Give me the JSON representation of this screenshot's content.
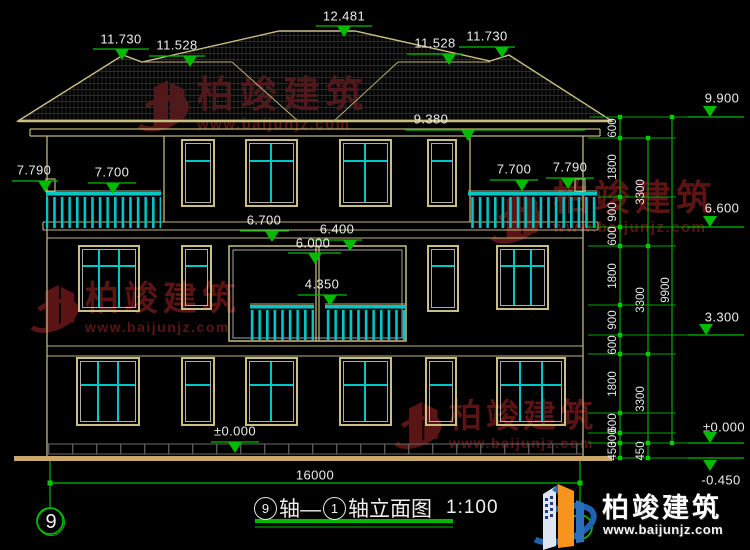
{
  "watermark": {
    "brand": "柏竣建筑",
    "site": "www.baijunjz.com"
  },
  "brand_logo": {
    "brand": "柏竣建筑",
    "site": "www.baijunjz.com"
  },
  "title": {
    "axis_start": "9",
    "axis_link": "轴—",
    "axis_end": "1",
    "suffix": "轴立面图",
    "scale": "1:100"
  },
  "axis_bubbles": {
    "left": "9",
    "right": "1"
  },
  "markers": {
    "roof_peak": "12.481",
    "left_ridge_high": "11.730",
    "left_ridge_low": "11.528",
    "right_ridge_low": "11.528",
    "right_ridge_high": "11.730",
    "eave": "9.380",
    "left_post": "7.790",
    "left_rail": "7.700",
    "right_rail": "7.700",
    "right_post": "7.790",
    "band_left": "6.700",
    "band_mid": "6.400",
    "band_center": "6.000",
    "balcony_mid": "4.350",
    "ground_center": "±0.000",
    "right_top": "9.900",
    "right_upper": "6.600",
    "right_lower": "3.300",
    "right_ground": "±0.000",
    "right_grade": "-0.450"
  },
  "dims": {
    "total_width": "16000",
    "col1": [
      "600",
      "1800",
      "900",
      "600",
      "1800",
      "900",
      "600",
      "1800",
      "600",
      "300",
      "450"
    ],
    "col2": [
      "3300",
      "3300",
      "3300",
      "450"
    ],
    "col3": [
      "9900"
    ]
  }
}
